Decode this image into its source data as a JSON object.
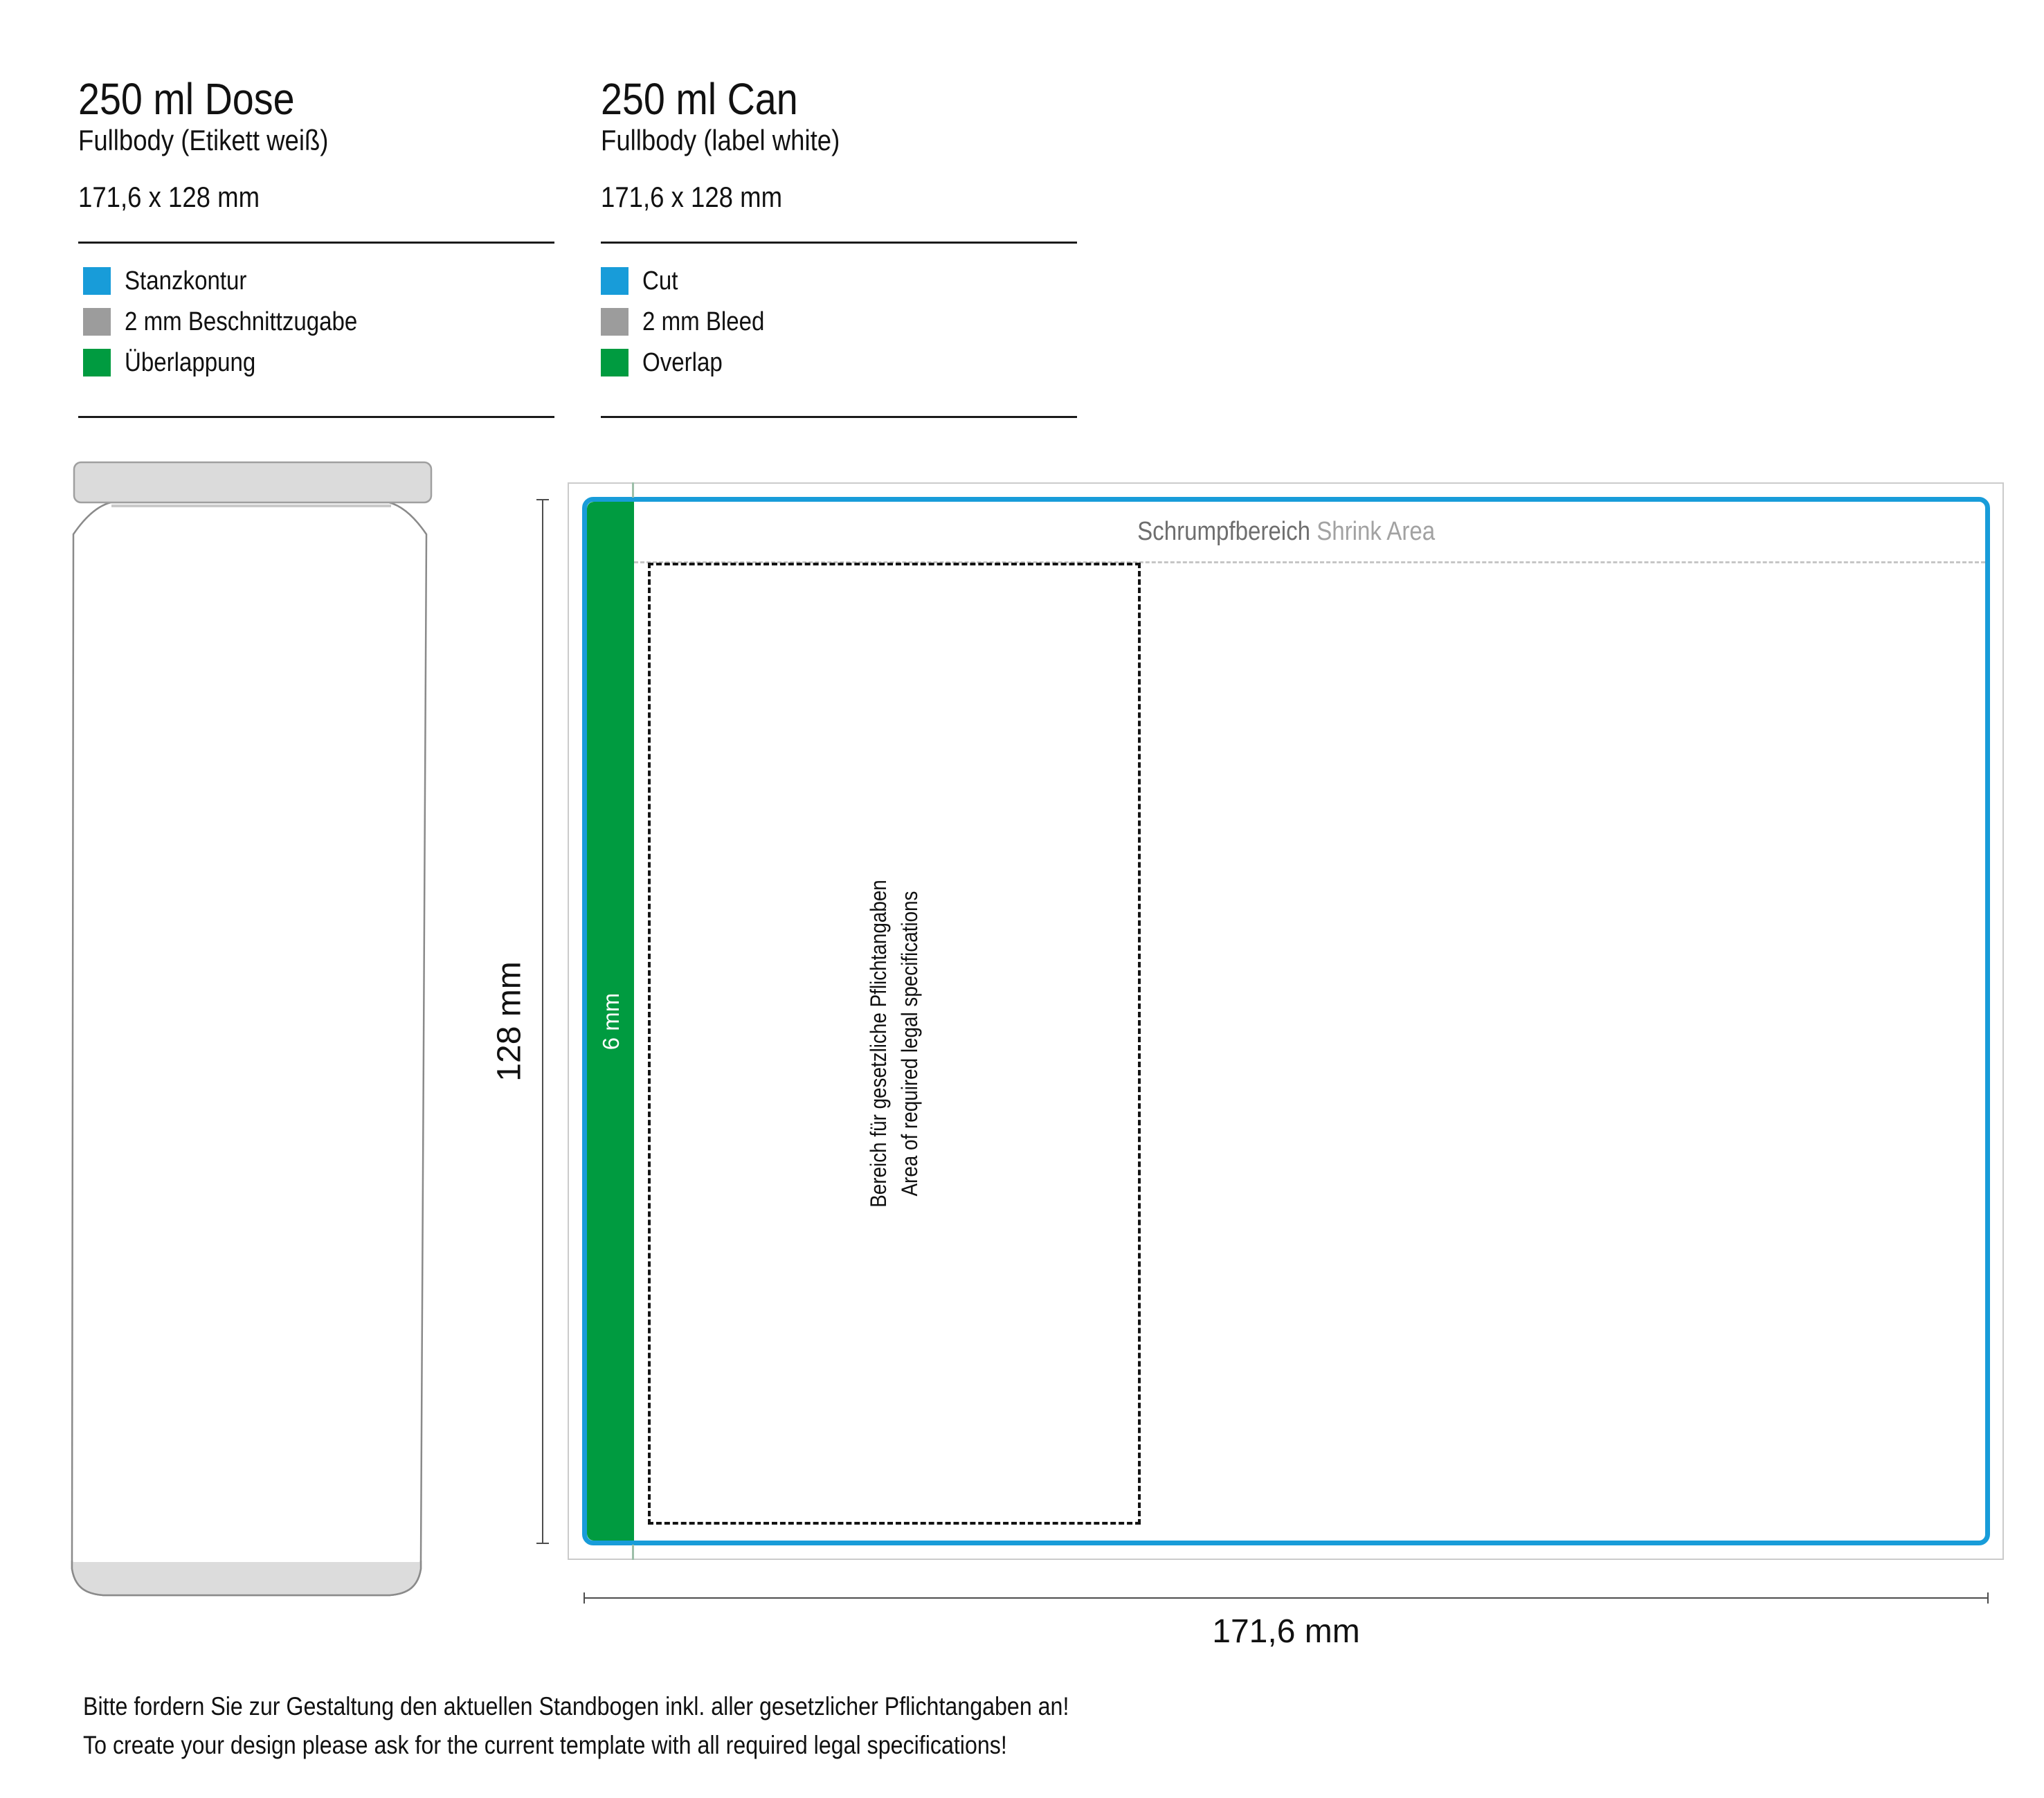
{
  "left_panel": {
    "title": "250 ml Dose",
    "subtitle": "Fullbody (Etikett weiß)",
    "size": "171,6 x 128 mm",
    "legend": [
      {
        "label": "Stanzkontur",
        "color": "#189CD9"
      },
      {
        "label": "2 mm Beschnittzugabe",
        "color": "#9C9C9C"
      },
      {
        "label": "Überlappung",
        "color": "#009B40"
      }
    ]
  },
  "right_panel": {
    "title": "250 ml Can",
    "subtitle": "Fullbody (label white)",
    "size": "171,6 x 128 mm",
    "legend": [
      {
        "label": "Cut",
        "color": "#189CD9"
      },
      {
        "label": "2 mm Bleed",
        "color": "#9C9C9C"
      },
      {
        "label": "Overlap",
        "color": "#009B40"
      }
    ]
  },
  "diagram": {
    "shrink_label_de": "Schrumpfbereich",
    "shrink_label_en": "Shrink Area",
    "overlap_width": "6 mm",
    "legal_line_de": "Bereich für gesetzliche Pflichtangaben",
    "legal_line_en": "Area of required legal specifications",
    "height_dim": "128 mm",
    "width_dim": "171,6 mm"
  },
  "footer": {
    "line_de": "Bitte fordern Sie zur Gestaltung den aktuellen Standbogen inkl. aller gesetzlicher Pflichtangaben an!",
    "line_en": "To create your design please ask for the current template with all required legal specifications!"
  },
  "colors": {
    "cut": "#189CD9",
    "bleed": "#9C9C9C",
    "overlap": "#009B40"
  }
}
